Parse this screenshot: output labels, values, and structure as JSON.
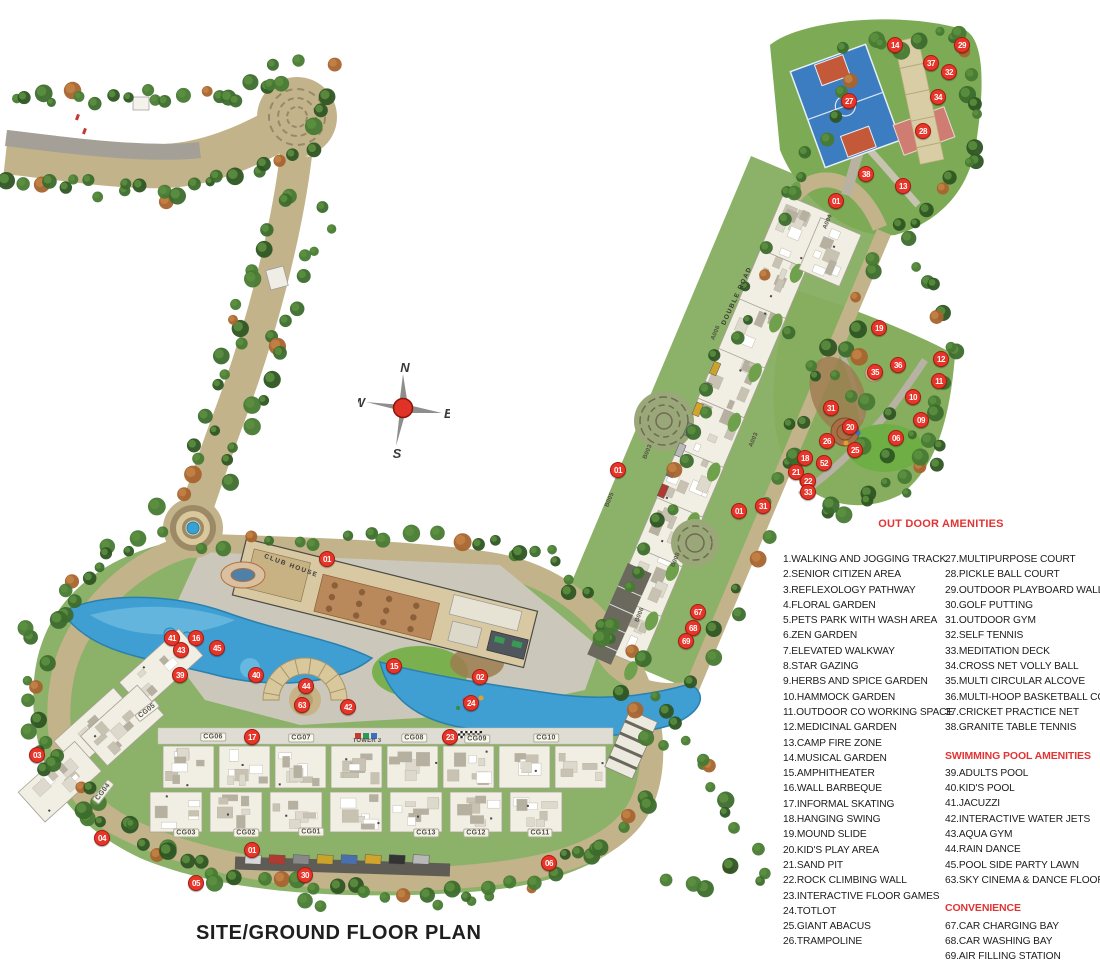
{
  "title": "SITE/GROUND FLOOR PLAN",
  "compass": {
    "n": "N",
    "e": "E",
    "w": "W",
    "s": "S"
  },
  "colors": {
    "marker_red": "#e8352a",
    "legend_red": "#e23434",
    "road_tan": "#c2b38a",
    "land_green": "#8cb168",
    "pool_blue": "#3f9fd2",
    "court_blue": "#3c7cc0",
    "court_pink": "#cf7d72",
    "title_black": "#1e1e1e"
  },
  "legend": {
    "outdoor": {
      "header": "OUT DOOR AMENITIES",
      "col1": [
        "1.WALKING AND JOGGING TRACK",
        "2.SENIOR CITIZEN AREA",
        "3.REFLEXOLOGY PATHWAY",
        "4.FLORAL GARDEN",
        "5.PETS PARK WITH WASH AREA",
        "6.ZEN GARDEN",
        "7.ELEVATED WALKWAY",
        "8.STAR GAZING",
        "9.HERBS AND SPICE GARDEN",
        "10.HAMMOCK GARDEN",
        "11.OUTDOOR CO WORKING SPACE",
        "12.MEDICINAL GARDEN",
        "13.CAMP FIRE ZONE",
        "14.MUSICAL GARDEN",
        "15.AMPHITHEATER",
        "16.WALL BARBEQUE",
        "17.INFORMAL SKATING",
        "18.HANGING SWING",
        "19.MOUND SLIDE",
        "20.KID'S PLAY AREA",
        "21.SAND PIT",
        "22.ROCK CLIMBING WALL",
        "23.INTERACTIVE FLOOR GAMES",
        "24.TOTLOT",
        "25.GIANT ABACUS",
        "26.TRAMPOLINE"
      ],
      "col2": [
        "27.MULTIPURPOSE COURT",
        "28.PICKLE BALL COURT",
        "29.OUTDOOR PLAYBOARD WALL",
        "30.GOLF PUTTING",
        "31.OUTDOOR GYM",
        "32.SELF TENNIS",
        "33.MEDITATION DECK",
        "34.CROSS NET VOLLY BALL",
        "35.MULTI CIRCULAR ALCOVE",
        "36.MULTI-HOOP BASKETBALL COURT",
        "37.CRICKET PRACTICE NET",
        "38.GRANITE TABLE TENNIS"
      ]
    },
    "swimming": {
      "header": "SWIMMING POOL AMENITIES",
      "items": [
        "39.ADULTS POOL",
        "40.KID'S POOL",
        "41.JACUZZI",
        "42.INTERACTIVE WATER JETS",
        "43.AQUA GYM",
        "44.RAIN DANCE",
        "45.POOL SIDE PARTY LAWN",
        "63.SKY CINEMA & DANCE FLOOR"
      ]
    },
    "convenience": {
      "header": "CONVENIENCE",
      "items": [
        "67.CAR CHARGING BAY",
        "68.CAR WASHING BAY",
        "69.AIR FILLING STATION"
      ]
    }
  },
  "plan": {
    "markers": [
      {
        "n": "14",
        "x": 895,
        "y": 45
      },
      {
        "n": "29",
        "x": 962,
        "y": 45
      },
      {
        "n": "37",
        "x": 931,
        "y": 63
      },
      {
        "n": "32",
        "x": 949,
        "y": 72
      },
      {
        "n": "34",
        "x": 938,
        "y": 97
      },
      {
        "n": "27",
        "x": 849,
        "y": 101
      },
      {
        "n": "28",
        "x": 923,
        "y": 131
      },
      {
        "n": "38",
        "x": 866,
        "y": 174
      },
      {
        "n": "13",
        "x": 903,
        "y": 186
      },
      {
        "n": "01",
        "x": 836,
        "y": 201
      },
      {
        "n": "19",
        "x": 879,
        "y": 328
      },
      {
        "n": "12",
        "x": 941,
        "y": 359
      },
      {
        "n": "36",
        "x": 898,
        "y": 365
      },
      {
        "n": "35",
        "x": 875,
        "y": 372
      },
      {
        "n": "11",
        "x": 939,
        "y": 381
      },
      {
        "n": "10",
        "x": 913,
        "y": 397
      },
      {
        "n": "31",
        "x": 831,
        "y": 408
      },
      {
        "n": "09",
        "x": 921,
        "y": 420
      },
      {
        "n": "20",
        "x": 850,
        "y": 427
      },
      {
        "n": "06",
        "x": 896,
        "y": 438
      },
      {
        "n": "26",
        "x": 827,
        "y": 441
      },
      {
        "n": "25",
        "x": 855,
        "y": 450
      },
      {
        "n": "18",
        "x": 805,
        "y": 458
      },
      {
        "n": "52",
        "x": 824,
        "y": 463
      },
      {
        "n": "21",
        "x": 796,
        "y": 472
      },
      {
        "n": "22",
        "x": 808,
        "y": 481
      },
      {
        "n": "33",
        "x": 808,
        "y": 492
      },
      {
        "n": "01",
        "x": 618,
        "y": 470
      },
      {
        "n": "31",
        "x": 763,
        "y": 506
      },
      {
        "n": "01",
        "x": 739,
        "y": 511
      },
      {
        "n": "67",
        "x": 698,
        "y": 612
      },
      {
        "n": "68",
        "x": 693,
        "y": 628
      },
      {
        "n": "69",
        "x": 686,
        "y": 641
      },
      {
        "n": "01",
        "x": 327,
        "y": 559
      },
      {
        "n": "41",
        "x": 172,
        "y": 638
      },
      {
        "n": "16",
        "x": 196,
        "y": 638
      },
      {
        "n": "43",
        "x": 181,
        "y": 650
      },
      {
        "n": "45",
        "x": 217,
        "y": 648
      },
      {
        "n": "39",
        "x": 180,
        "y": 675
      },
      {
        "n": "40",
        "x": 256,
        "y": 675
      },
      {
        "n": "15",
        "x": 394,
        "y": 666
      },
      {
        "n": "02",
        "x": 480,
        "y": 677
      },
      {
        "n": "44",
        "x": 306,
        "y": 686
      },
      {
        "n": "63",
        "x": 302,
        "y": 705
      },
      {
        "n": "42",
        "x": 348,
        "y": 707
      },
      {
        "n": "24",
        "x": 471,
        "y": 703
      },
      {
        "n": "17",
        "x": 252,
        "y": 737
      },
      {
        "n": "23",
        "x": 450,
        "y": 737
      },
      {
        "n": "03",
        "x": 37,
        "y": 755
      },
      {
        "n": "04",
        "x": 102,
        "y": 838
      },
      {
        "n": "01",
        "x": 252,
        "y": 850
      },
      {
        "n": "30",
        "x": 305,
        "y": 875
      },
      {
        "n": "05",
        "x": 196,
        "y": 883
      },
      {
        "n": "06",
        "x": 549,
        "y": 863
      }
    ],
    "labels": [
      {
        "t": "CG05",
        "x": 147,
        "y": 711,
        "r": -38,
        "cls": "bldg"
      },
      {
        "t": "CG06",
        "x": 213,
        "y": 737,
        "r": 0,
        "cls": "bldg"
      },
      {
        "t": "CG07",
        "x": 301,
        "y": 738,
        "r": 0,
        "cls": "bldg"
      },
      {
        "t": "CG08",
        "x": 414,
        "y": 738,
        "r": 0,
        "cls": "bldg"
      },
      {
        "t": "CG09",
        "x": 477,
        "y": 739,
        "r": 0,
        "cls": "bldg"
      },
      {
        "t": "CG10",
        "x": 546,
        "y": 738,
        "r": 0,
        "cls": "bldg"
      },
      {
        "t": "CG04",
        "x": 103,
        "y": 792,
        "r": -52,
        "cls": "bldg"
      },
      {
        "t": "CG03",
        "x": 186,
        "y": 833,
        "r": 0,
        "cls": "bldg"
      },
      {
        "t": "CG02",
        "x": 246,
        "y": 833,
        "r": 0,
        "cls": "bldg"
      },
      {
        "t": "CG01",
        "x": 311,
        "y": 832,
        "r": 0,
        "cls": "bldg"
      },
      {
        "t": "CG13",
        "x": 426,
        "y": 833,
        "r": 0,
        "cls": "bldg"
      },
      {
        "t": "CG12",
        "x": 476,
        "y": 833,
        "r": 0,
        "cls": "bldg"
      },
      {
        "t": "CG11",
        "x": 540,
        "y": 833,
        "r": 0,
        "cls": "bldg"
      },
      {
        "t": "TOWER 3",
        "x": 367,
        "y": 741,
        "r": 0,
        "cls": "tower"
      },
      {
        "t": "A004",
        "x": 828,
        "y": 222,
        "r": -67,
        "cls": "tower"
      },
      {
        "t": "A006",
        "x": 716,
        "y": 333,
        "r": -67,
        "cls": "tower"
      },
      {
        "t": "A003",
        "x": 754,
        "y": 440,
        "r": -67,
        "cls": "tower"
      },
      {
        "t": "B003",
        "x": 648,
        "y": 452,
        "r": -67,
        "cls": "tower"
      },
      {
        "t": "B005",
        "x": 610,
        "y": 500,
        "r": -67,
        "cls": "tower"
      },
      {
        "t": "B008",
        "x": 676,
        "y": 560,
        "r": -67,
        "cls": "tower"
      },
      {
        "t": "B006",
        "x": 640,
        "y": 615,
        "r": -67,
        "cls": "tower"
      },
      {
        "t": "CLUB HOUSE",
        "x": 291,
        "y": 566,
        "r": 20,
        "cls": "area"
      },
      {
        "t": "DOUBLE ROAD",
        "x": 737,
        "y": 296,
        "r": -65,
        "cls": "area"
      }
    ]
  }
}
